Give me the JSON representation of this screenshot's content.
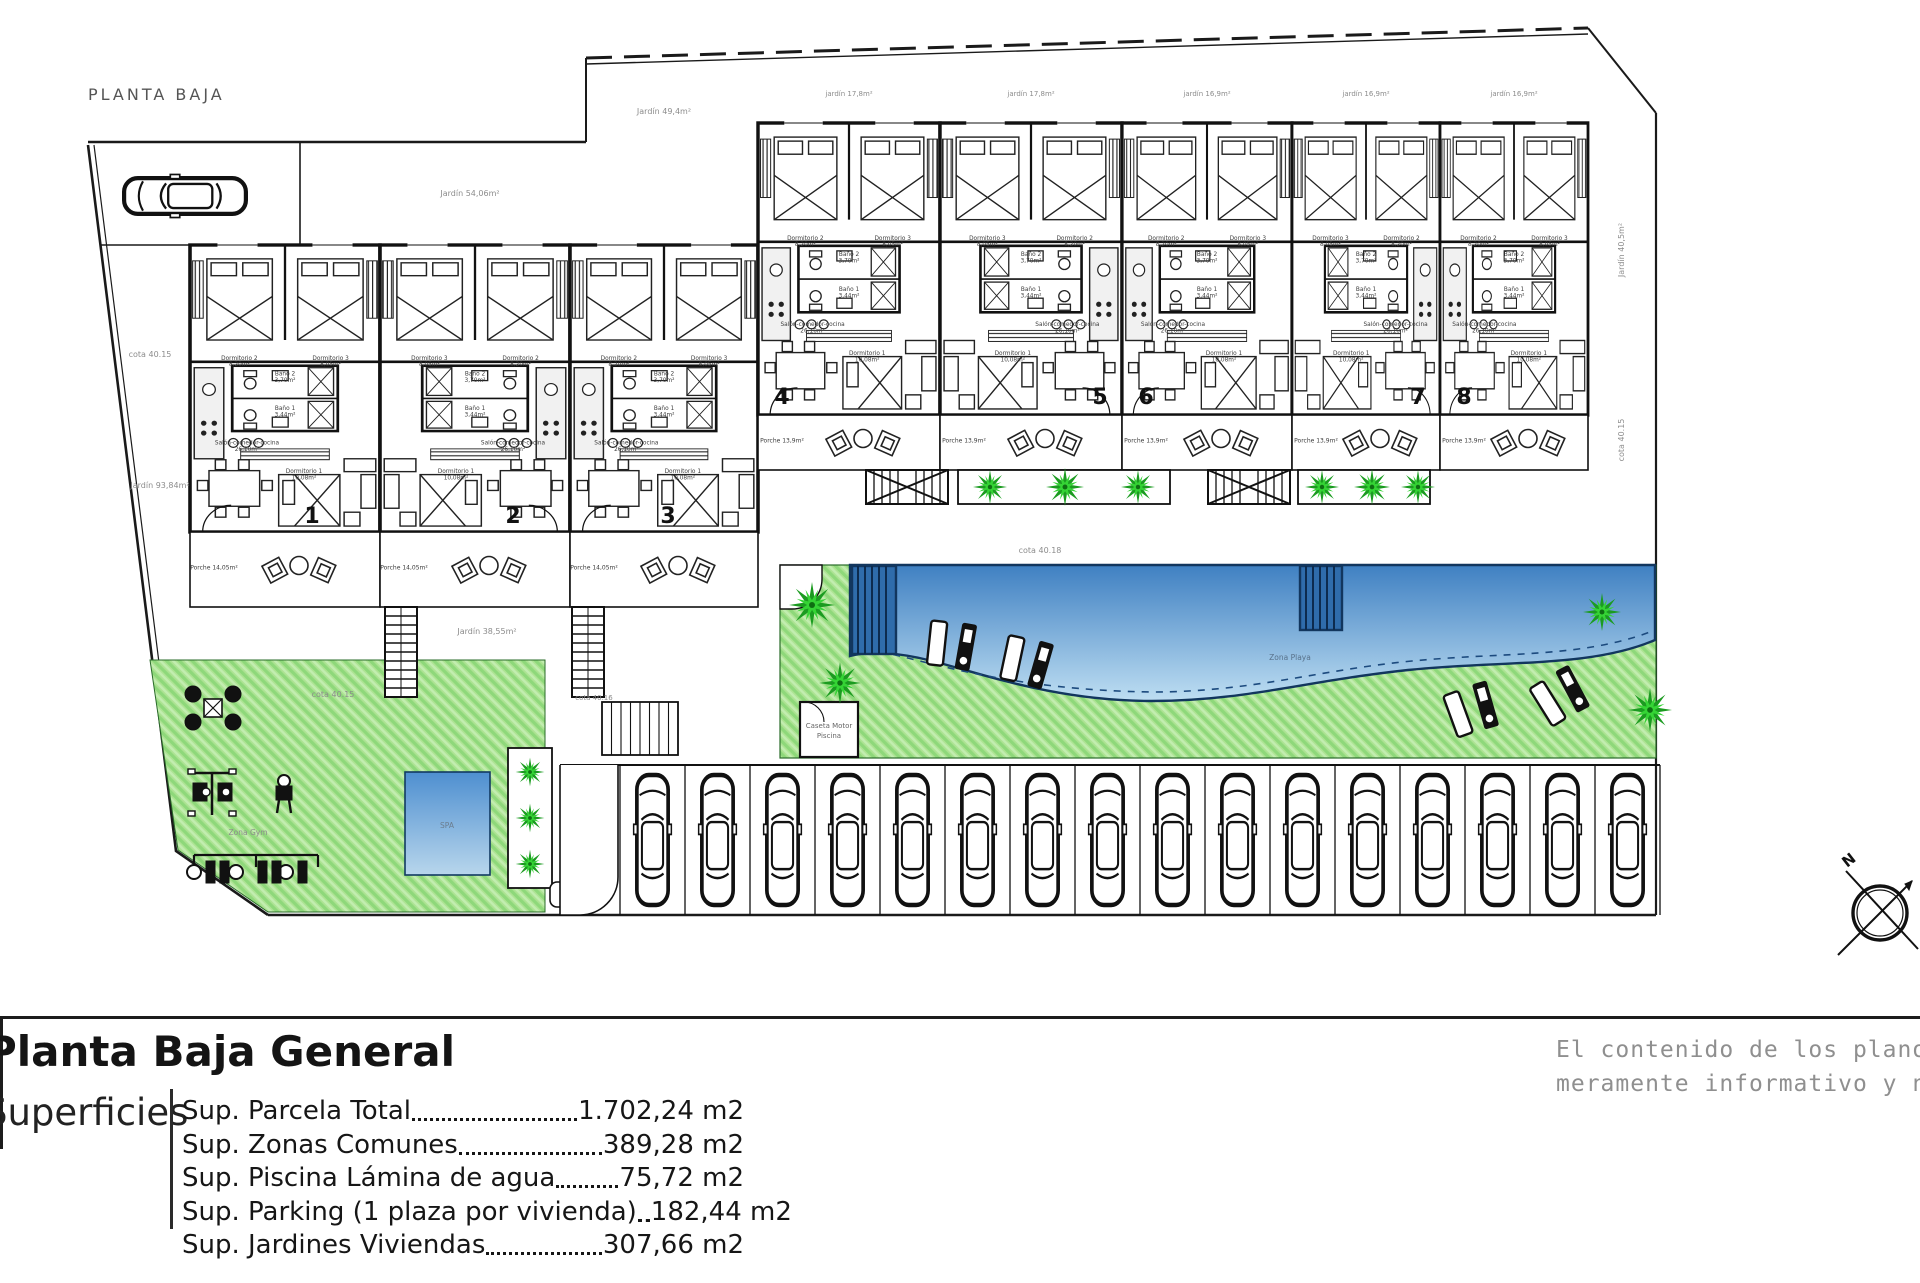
{
  "plan_title": "PLANTA BAJA",
  "legend": {
    "heading": "Planta Baja General",
    "side_label": "Superficies",
    "rows": [
      {
        "label": "Sup. Parcela Total ",
        "value": "1.702,24 m2"
      },
      {
        "label": "Sup. Zonas Comunes ",
        "value": "389,28 m2"
      },
      {
        "label": "Sup. Piscina Lámina de agua",
        "value": "75,72 m2"
      },
      {
        "label": "Sup. Parking (1 plaza por vivienda)",
        "value": "182,44 m2"
      },
      {
        "label": "Sup. Jardines Viviendas",
        "value": "307,66 m2"
      }
    ]
  },
  "disclaimer": {
    "line1": "El contenido de los planos tiene valo",
    "line2": "meramente informativo y no vinculan"
  },
  "compass": {
    "label": "N"
  },
  "pool": {
    "label": "Zona Playa"
  },
  "spa": {
    "label": "SPA"
  },
  "gym": {
    "label": "Zona Gym"
  },
  "shed": {
    "line1": "Caseta Motor",
    "line2": "Piscina"
  },
  "units": [
    {
      "num": "1",
      "x": 190,
      "y": 245,
      "w": 190,
      "h": 287,
      "mirror": false,
      "numX": 312,
      "numY": 523
    },
    {
      "num": "2",
      "x": 380,
      "y": 245,
      "w": 190,
      "h": 287,
      "mirror": true,
      "numX": 513,
      "numY": 523
    },
    {
      "num": "3",
      "x": 570,
      "y": 245,
      "w": 188,
      "h": 287,
      "mirror": false,
      "numX": 668,
      "numY": 523
    },
    {
      "num": "4",
      "x": 758,
      "y": 123,
      "w": 182,
      "h": 292,
      "mirror": false,
      "numX": 782,
      "numY": 404
    },
    {
      "num": "5",
      "x": 940,
      "y": 123,
      "w": 182,
      "h": 292,
      "mirror": true,
      "numX": 1100,
      "numY": 404
    },
    {
      "num": "6",
      "x": 1122,
      "y": 123,
      "w": 170,
      "h": 292,
      "mirror": false,
      "numX": 1146,
      "numY": 404
    },
    {
      "num": "7",
      "x": 1292,
      "y": 123,
      "w": 148,
      "h": 292,
      "mirror": true,
      "numX": 1418,
      "numY": 404
    },
    {
      "num": "8",
      "x": 1440,
      "y": 123,
      "w": 148,
      "h": 292,
      "mirror": false,
      "numX": 1464,
      "numY": 404
    }
  ],
  "rooms": [
    {
      "n": "Dormitorio 2",
      "a": "8,20m²",
      "fx": 0.26,
      "fy": 0.4
    },
    {
      "n": "Dormitorio 3",
      "a": "8,05m²",
      "fx": 0.74,
      "fy": 0.4
    },
    {
      "n": "Baño 2",
      "a": "3,70m²",
      "fx": 0.5,
      "fy": 0.455
    },
    {
      "n": "Baño 1",
      "a": "3,44m²",
      "fx": 0.5,
      "fy": 0.575
    },
    {
      "n": "Salón-comedor-cocina",
      "a": "26,10m²",
      "fx": 0.3,
      "fy": 0.695
    },
    {
      "n": "Dormitorio 1",
      "a": "10,08m²",
      "fx": 0.6,
      "fy": 0.795
    }
  ],
  "porches": {
    "left": {
      "label": "Porche 14,05m²",
      "y": 532,
      "h": 75,
      "cells": [
        {
          "x": 190,
          "w": 190
        },
        {
          "x": 380,
          "w": 190
        },
        {
          "x": 570,
          "w": 188
        }
      ]
    },
    "right": {
      "label": "Porche 13,9m²",
      "y": 415,
      "h": 55,
      "cells": [
        {
          "x": 758,
          "w": 182
        },
        {
          "x": 940,
          "w": 182
        },
        {
          "x": 1122,
          "w": 170
        },
        {
          "x": 1292,
          "w": 148
        },
        {
          "x": 1440,
          "w": 148
        }
      ]
    }
  },
  "labels": [
    {
      "t": "Jardín 54,06m²",
      "x": 470,
      "y": 196,
      "s": 8,
      "r": 0
    },
    {
      "t": "Jardín 49,4m²",
      "x": 664,
      "y": 114,
      "s": 8,
      "r": 0
    },
    {
      "t": "jardín 17,8m²",
      "x": 849,
      "y": 96,
      "s": 7,
      "r": 0
    },
    {
      "t": "jardín 17,8m²",
      "x": 1031,
      "y": 96,
      "s": 7,
      "r": 0
    },
    {
      "t": "jardín 16,9m²",
      "x": 1207,
      "y": 96,
      "s": 7,
      "r": 0
    },
    {
      "t": "jardín 16,9m²",
      "x": 1366,
      "y": 96,
      "s": 7,
      "r": 0
    },
    {
      "t": "jardín 16,9m²",
      "x": 1514,
      "y": 96,
      "s": 7,
      "r": 0
    },
    {
      "t": "cota 40.15",
      "x": 150,
      "y": 357,
      "s": 8,
      "r": 0
    },
    {
      "t": "Jardín 93,84m²",
      "x": 160,
      "y": 488,
      "s": 8,
      "r": 0
    },
    {
      "t": "cota 40.15",
      "x": 333,
      "y": 697,
      "s": 8,
      "r": 0
    },
    {
      "t": "Jardín 38,55m²",
      "x": 487,
      "y": 634,
      "s": 8,
      "r": 0
    },
    {
      "t": "cota 40.18",
      "x": 1040,
      "y": 553,
      "s": 8,
      "r": 0
    },
    {
      "t": "Jardín 40,5m²",
      "x": 1624,
      "y": 250,
      "s": 8,
      "r": -90
    },
    {
      "t": "cota 40.15",
      "x": 1624,
      "y": 440,
      "s": 8,
      "r": -90
    },
    {
      "t": "cota 40.16",
      "x": 594,
      "y": 700,
      "s": 7,
      "r": 0
    }
  ],
  "parking": {
    "count": 16,
    "x": 620,
    "y": 765,
    "stall_w": 65,
    "h": 150
  },
  "bike_rack": {
    "x": 602,
    "y": 702,
    "w": 76,
    "h": 53,
    "slots": 7
  },
  "palms": [
    {
      "x": 812,
      "y": 605,
      "s": 1.15
    },
    {
      "x": 840,
      "y": 683,
      "s": 1.05
    },
    {
      "x": 990,
      "y": 487,
      "s": 0.85
    },
    {
      "x": 1065,
      "y": 487,
      "s": 0.95
    },
    {
      "x": 1138,
      "y": 487,
      "s": 0.85
    },
    {
      "x": 1322,
      "y": 487,
      "s": 0.85
    },
    {
      "x": 1372,
      "y": 487,
      "s": 0.9
    },
    {
      "x": 1418,
      "y": 487,
      "s": 0.85
    },
    {
      "x": 1650,
      "y": 710,
      "s": 1.1
    },
    {
      "x": 1602,
      "y": 612,
      "s": 0.95
    },
    {
      "x": 530,
      "y": 772,
      "s": 0.72
    },
    {
      "x": 530,
      "y": 818,
      "s": 0.72
    },
    {
      "x": 530,
      "y": 864,
      "s": 0.72
    }
  ],
  "loungers": [
    {
      "x": 955,
      "y": 645,
      "r": 14
    },
    {
      "x": 1030,
      "y": 662,
      "r": 20
    },
    {
      "x": 1475,
      "y": 708,
      "r": -12
    },
    {
      "x": 1563,
      "y": 694,
      "r": -24
    }
  ],
  "stairs_v": [
    {
      "x": 385,
      "y": 607
    },
    {
      "x": 572,
      "y": 607
    }
  ],
  "stairs_h": [
    {
      "x": 866,
      "y": 470
    },
    {
      "x": 1208,
      "y": 470
    }
  ],
  "planters": [
    {
      "x": 958,
      "y": 470,
      "w": 212,
      "h": 34
    },
    {
      "x": 1298,
      "y": 470,
      "w": 132,
      "h": 34
    }
  ],
  "colors": {
    "line": "#1a1a1a",
    "lawn_base": "#ade393",
    "lawn_stripe_dark": "#8ed87a",
    "lawn_stripe_light": "#c2edb0",
    "pool_top": "#3f80c2",
    "pool_bottom": "#bedef2",
    "pool_edge": "#12365e",
    "palm_dark": "#1b9b20",
    "palm_light": "#35d435",
    "gray_text": "#8c8c8c",
    "room_text": "#3c3c3c"
  }
}
